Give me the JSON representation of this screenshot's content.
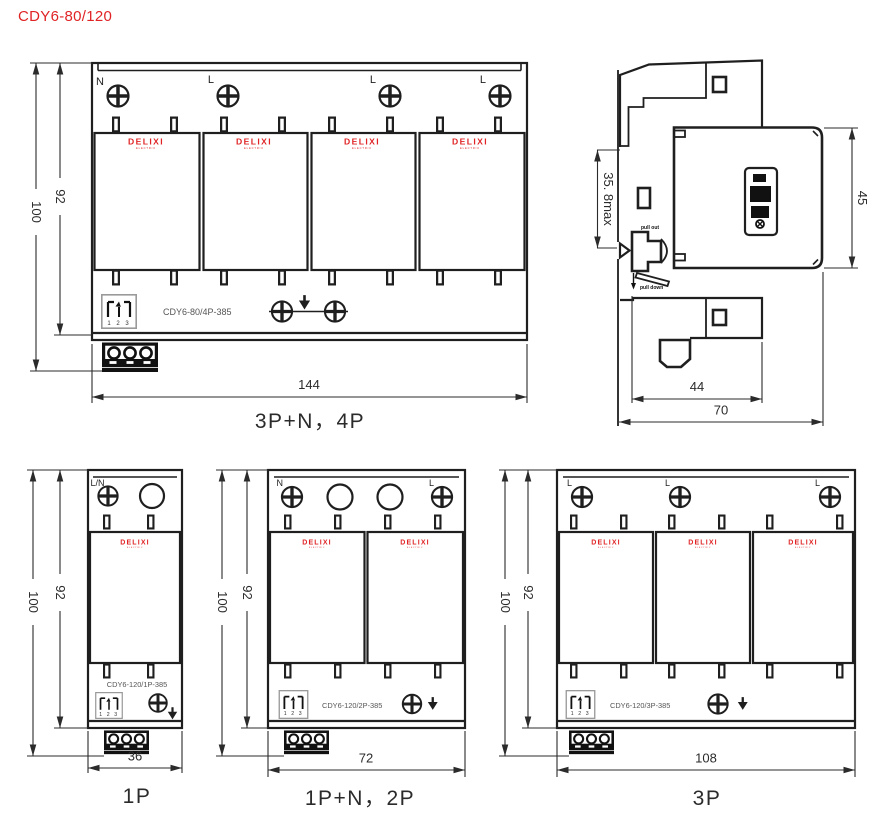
{
  "title": "CDY6-80/120",
  "brand": {
    "name": "DELIXI",
    "subtitle": "ELECTRIC"
  },
  "colors": {
    "brand_red": "#e02325",
    "line": "#1f1f1f"
  },
  "views": {
    "4p": {
      "caption": "3P+N，4P",
      "model": "CDY6-80/4P-385",
      "window_digits": "1 2 3",
      "terminals": {
        "t1": "N",
        "t2": "L",
        "t3": "L",
        "t4": "L"
      },
      "dims": {
        "width": "144",
        "height": "100",
        "body_height": "92"
      }
    },
    "side": {
      "dims": {
        "front_depth": "35. 8max",
        "rail_height": "45",
        "base_depth": "44",
        "total_depth": "70"
      },
      "labels": {
        "out": "pull out",
        "down": "pull down"
      }
    },
    "1p": {
      "caption": "1P",
      "model": "CDY6-120/1P-385",
      "window_digits": "1 2 3",
      "terminals": {
        "t1": "L/N"
      },
      "dims": {
        "width": "36",
        "height": "100",
        "body_height": "92"
      }
    },
    "2p": {
      "caption": "1P+N，2P",
      "model": "CDY6-120/2P-385",
      "window_digits": "1 2 3",
      "terminals": {
        "t1": "N",
        "t2": "L"
      },
      "dims": {
        "width": "72",
        "height": "100",
        "body_height": "92"
      }
    },
    "3p": {
      "caption": "3P",
      "model": "CDY6-120/3P-385",
      "window_digits": "1 2 3",
      "terminals": {
        "t1": "L",
        "t2": "L",
        "t3": "L"
      },
      "dims": {
        "width": "108",
        "height": "100",
        "body_height": "92"
      }
    }
  }
}
